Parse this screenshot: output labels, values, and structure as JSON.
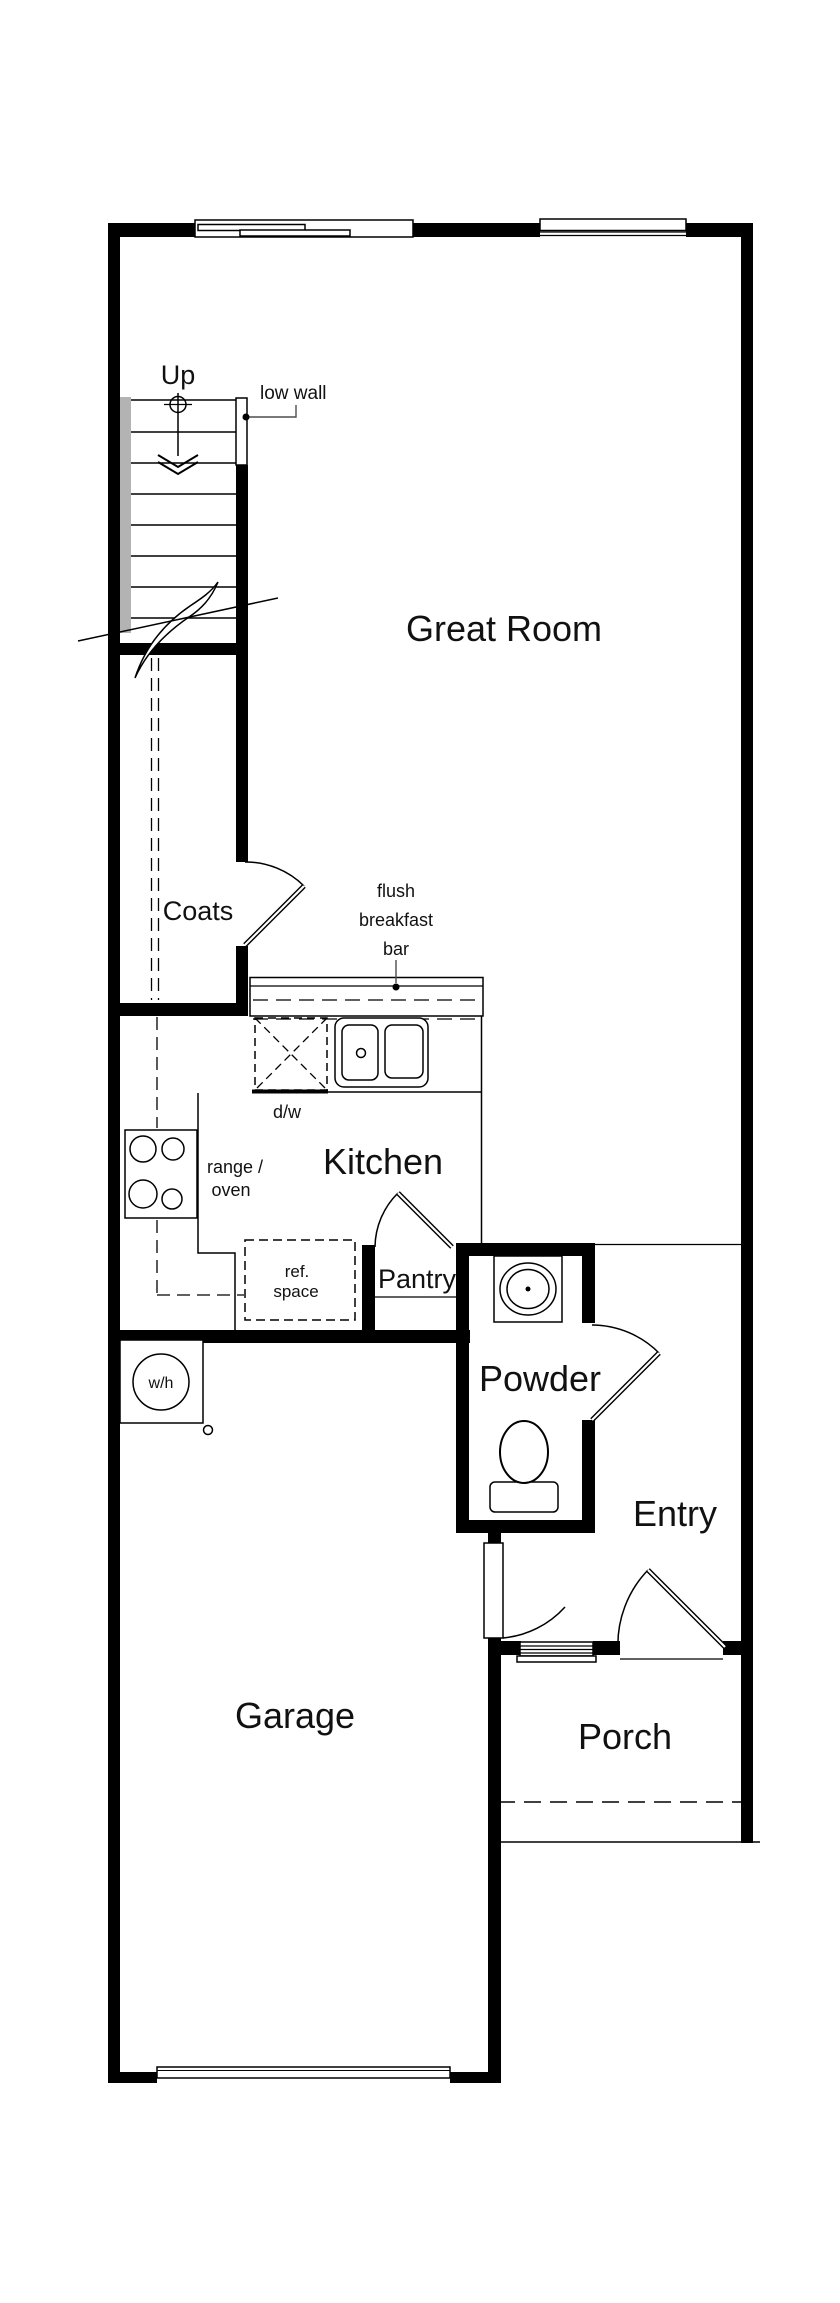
{
  "title": "First-floor residential floor plan",
  "colors": {
    "wall": "#000000",
    "background": "#ffffff",
    "stair_handrail": "#b3b3b3",
    "leader_line": "#4d4d4d",
    "text": "#111111"
  },
  "rooms": {
    "great_room": "Great Room",
    "kitchen": "Kitchen",
    "coats": "Coats",
    "pantry": "Pantry",
    "powder": "Powder",
    "entry": "Entry",
    "garage": "Garage",
    "porch": "Porch"
  },
  "annotations": {
    "up": "Up",
    "low_wall": "low wall",
    "breakfast_bar_line1": "flush",
    "breakfast_bar_line2": "breakfast",
    "breakfast_bar_line3": "bar",
    "dishwasher": "d/w",
    "range_line1": "range /",
    "range_line2": "oven",
    "ref_line1": "ref.",
    "ref_line2": "space",
    "water_heater": "w/h"
  }
}
